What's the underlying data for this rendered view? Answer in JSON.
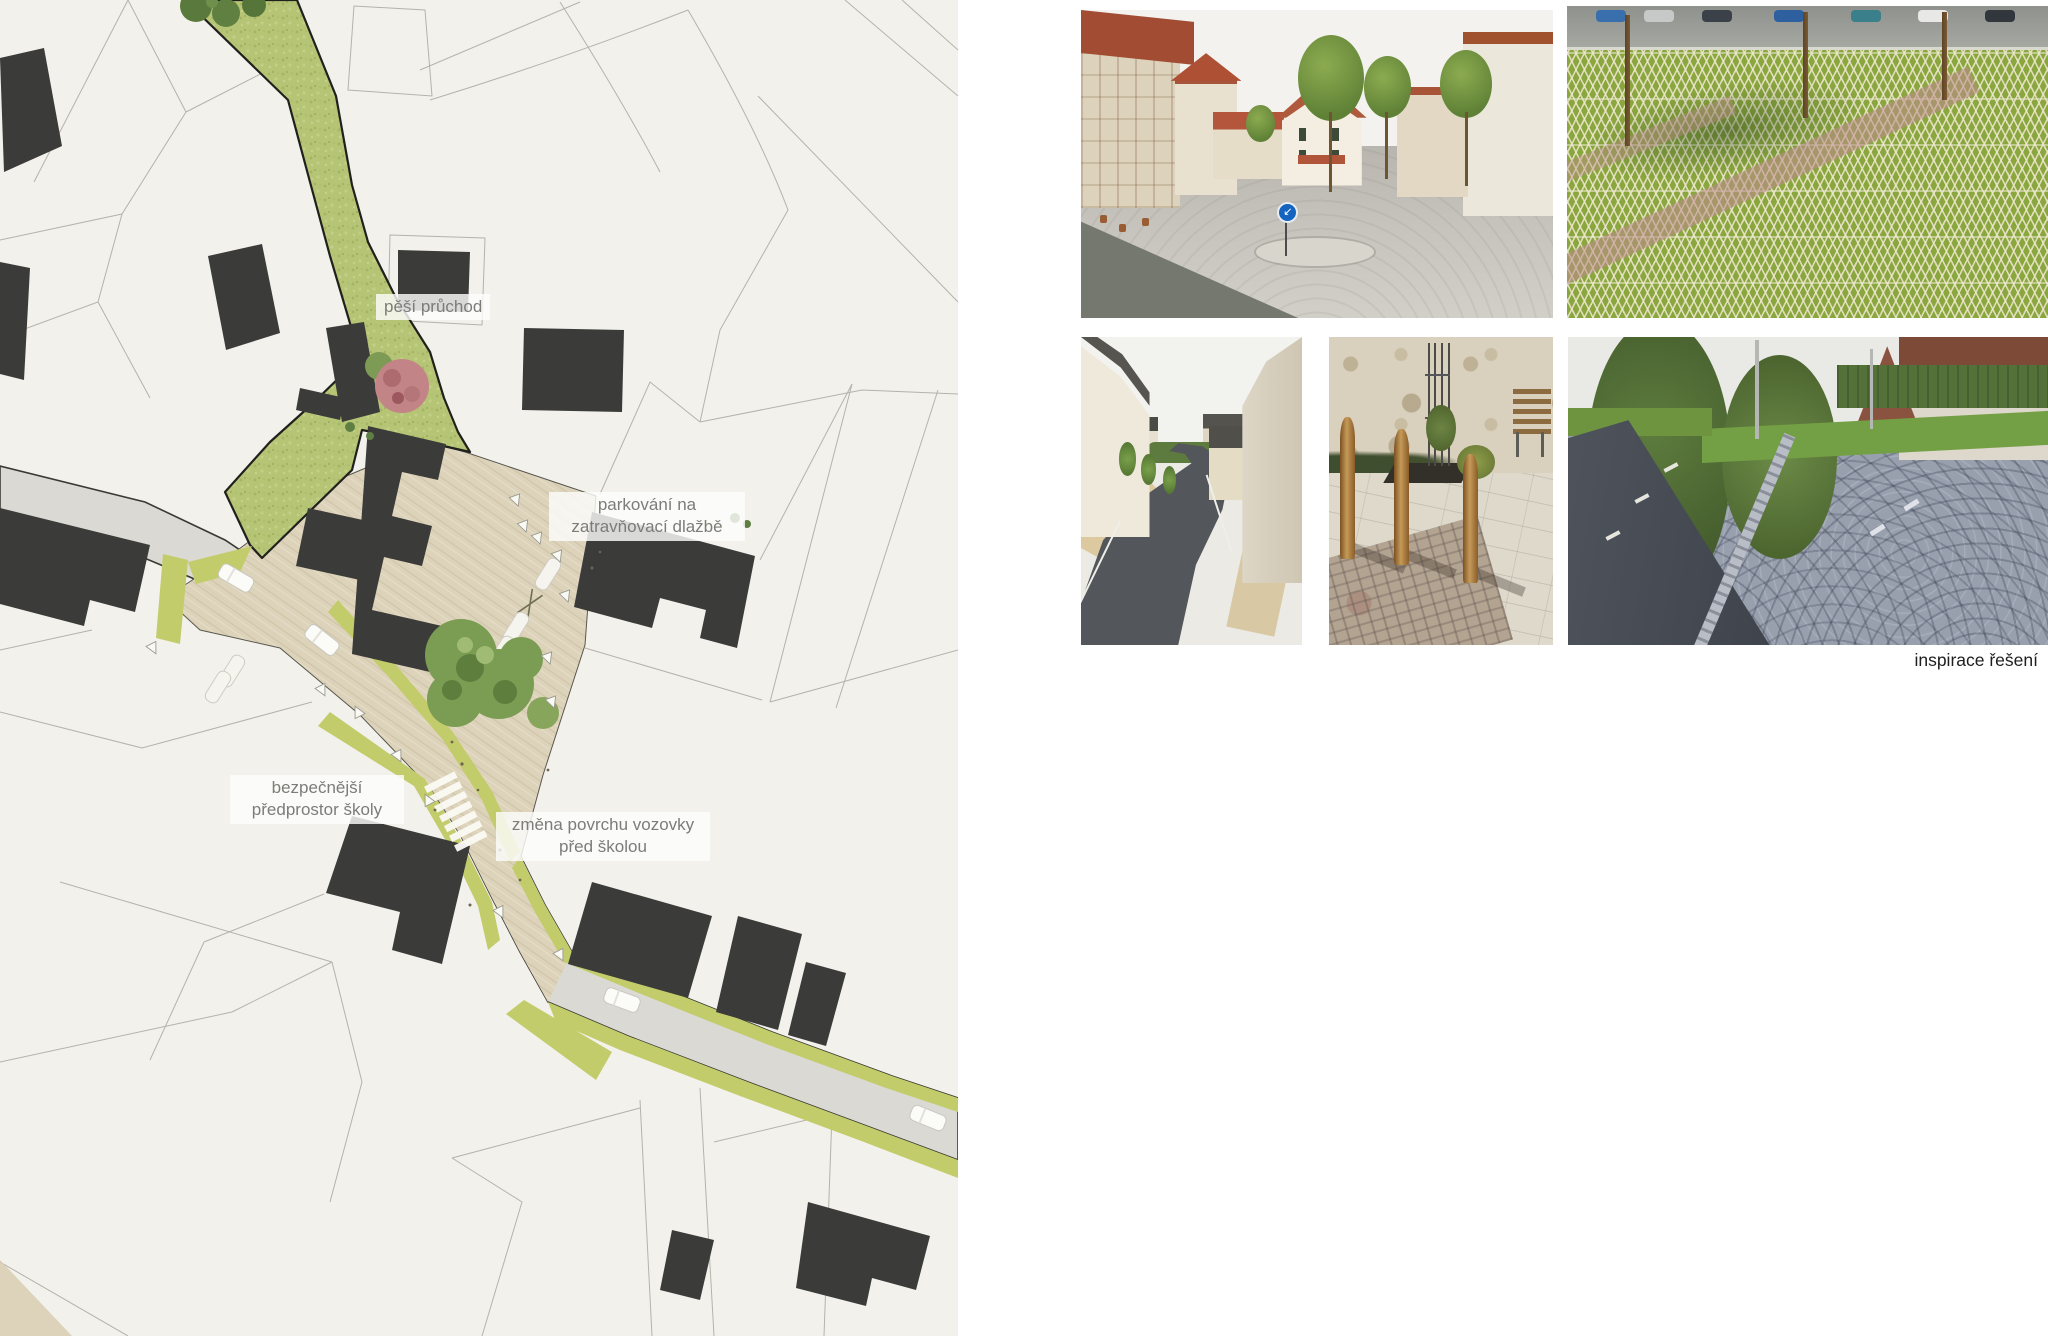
{
  "page": {
    "caption": "inspirace řešení"
  },
  "plan": {
    "labels": {
      "passage": "pěší průchod",
      "parking": "parkování na zatravňovací dlažbě",
      "forecourt": "bezpečnější předprostor školy",
      "surface": "změna povrchu vozovky před školou"
    },
    "legend_colors": {
      "background": "#f3f1ec",
      "building": "#3b3b39",
      "greenway": "#b6c475",
      "road_gray": "#dbd9d3",
      "paved_surface": "#ddd3ba",
      "roadside_green": "#c3cc6b",
      "parcel_line": "#b5b2aa",
      "label_text": "#7c7c78"
    }
  },
  "photos": [
    {
      "id": "village-street",
      "desc": "village main street with traffic island, trees and cobbled surface"
    },
    {
      "id": "grass-pavers",
      "desc": "parking area on grass paver blocks with marking of bays"
    },
    {
      "id": "narrow-street",
      "desc": "narrow street with new asphalt, sand verges and young trees"
    },
    {
      "id": "wooden-bollards",
      "desc": "wooden bollards, tree guard and bench on paved square"
    },
    {
      "id": "cobblestone-road",
      "desc": "fan-pattern cobblestone verge along an asphalt road"
    }
  ]
}
